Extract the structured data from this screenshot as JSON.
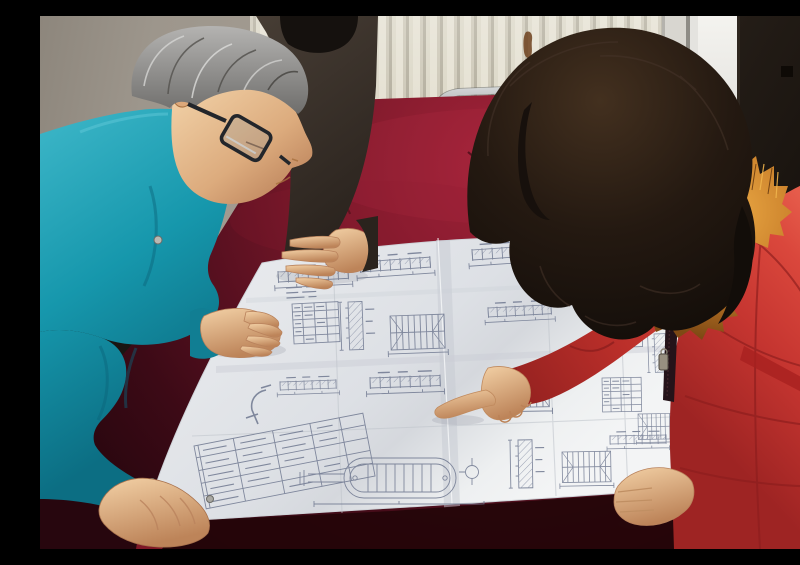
{
  "meta": {
    "description": "Three people lean over a large folded engineering blueprint spread on a dark red velvet-covered table: a gray-haired man in a teal work jacket and glasses studies the sheet, a colleague in a dark jacket rests a hand on it, and a woman in a red parka with orange fur-trimmed hood points at a detail.",
    "setting": "workshop room with pale wall, white column radiator, light door frame and dark door",
    "people_count": 3
  },
  "palette": {
    "wall": "#9d968c",
    "radiator": "#ddd9c9",
    "door-dark": "#171310",
    "velvet-hi": "#a32339",
    "velvet-mid": "#5c1121",
    "velvet-deep": "#27060e",
    "paper": "#e9ebee",
    "paper-shade": "#c6cad2",
    "ink": "#6f7890",
    "teal": "#1697ac",
    "teal-deep": "#0c6e83",
    "jacket-dark": "#2c251f",
    "hair-gray": "#8e8d8b",
    "hair-black": "#15110e",
    "hair-brown": "#201712",
    "skin": "#e9c096",
    "skin-shadow": "#bd8459",
    "coat-red": "#c53530",
    "coat-red-dark": "#8e1f1e",
    "fur-orange": "#c97f2a",
    "chrome": "#b9bdbe",
    "rust": "#6e421e"
  },
  "scene": {
    "objects": [
      {
        "name": "wall",
        "label": "pale plaster wall"
      },
      {
        "name": "radiator",
        "label": "white column radiator with vertical fins"
      },
      {
        "name": "rust-stain",
        "label": "rust stain on radiator"
      },
      {
        "name": "door-frame",
        "label": "light door frame strip"
      },
      {
        "name": "door-panel",
        "label": "dark door panel"
      },
      {
        "name": "chair-frame",
        "label": "chrome tube chair frame behind table"
      },
      {
        "name": "table-velvet",
        "label": "table draped in dark red velvet"
      },
      {
        "name": "blueprint-sheet",
        "label": "large folded engineering drawing with crease grid"
      },
      {
        "name": "title-block",
        "label": "tilted title-block table on sheet"
      },
      {
        "name": "vessel-drawing",
        "label": "capsule-shaped vessel detail drawing"
      },
      {
        "name": "colleague-behind",
        "label": "colleague in dark jacket, hand on drawing"
      },
      {
        "name": "engineer-left",
        "label": "gray-haired man, glasses, teal work jacket, leaning on table"
      },
      {
        "name": "woman-right",
        "label": "woman, long dark hair, red parka with orange fur hood, pointing"
      },
      {
        "name": "pointing-hand",
        "label": "index finger pointing at blueprint detail"
      }
    ]
  }
}
